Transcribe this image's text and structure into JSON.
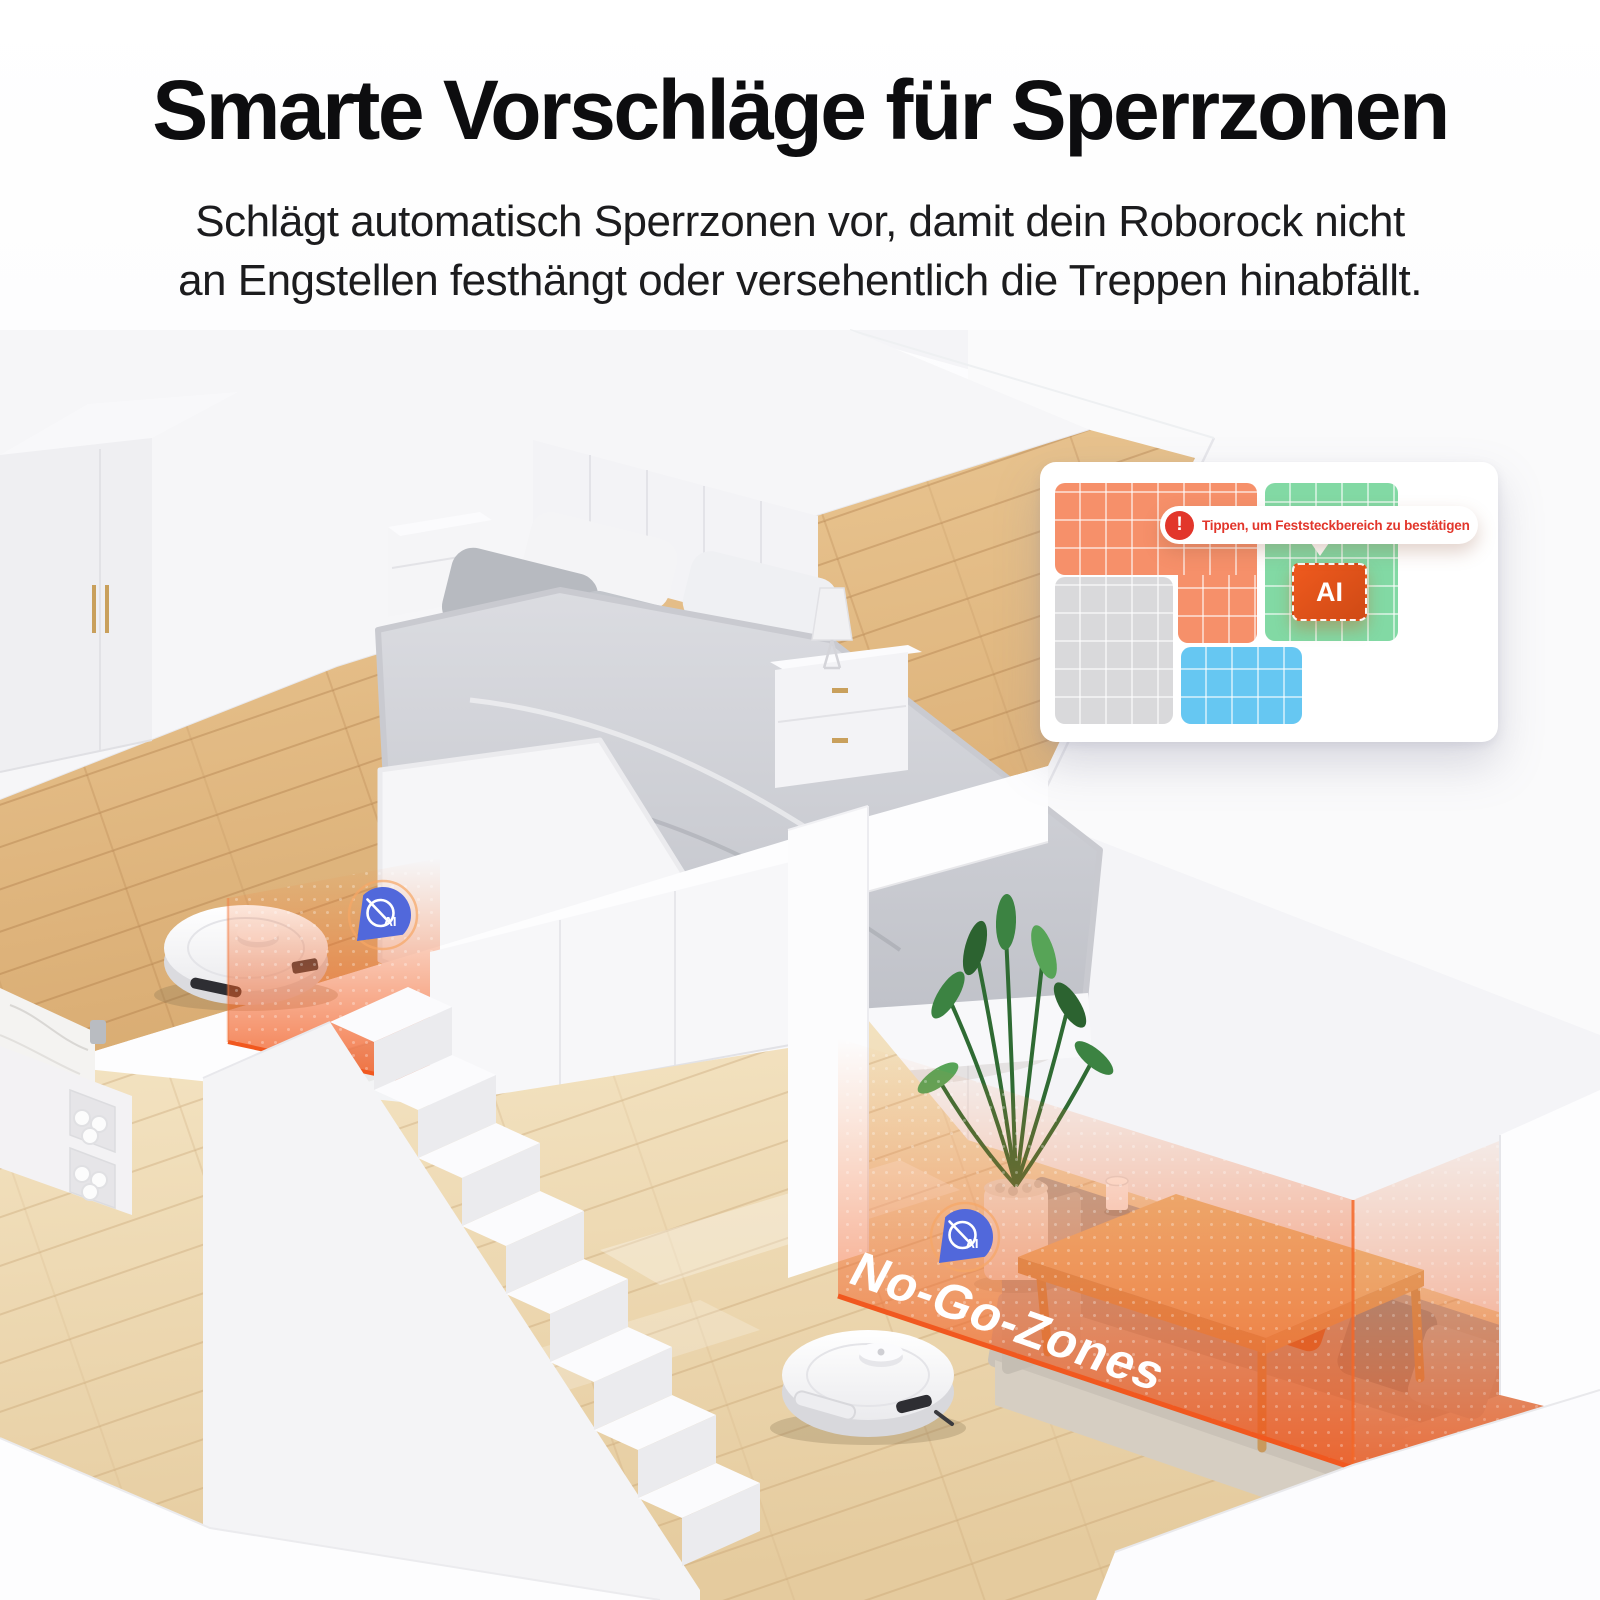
{
  "header": {
    "title": "Smarte Vorschläge für Sperrzonen",
    "subtitle_line1": "Schlägt automatisch Sperrzonen vor, damit dein Roborock nicht",
    "subtitle_line2": "an Engstellen festhängt oder versehentlich die Treppen hinabfällt."
  },
  "map_card": {
    "tooltip": {
      "icon_glyph": "!",
      "text": "Tippen, um Feststeckbereich zu bestätigen",
      "text_color": "#e2362b"
    },
    "ai_box_label": "AI",
    "zones": {
      "orange": "#f6906a",
      "green": "#82d9a4",
      "gray": "#d9d9db",
      "blue": "#66c7f2"
    }
  },
  "scene": {
    "no_go_label": "No-Go-Zones",
    "ai_badge_label": "AI",
    "colors": {
      "zone_edge_orange": "#f1581f",
      "badge_blue": "#5168db"
    }
  }
}
